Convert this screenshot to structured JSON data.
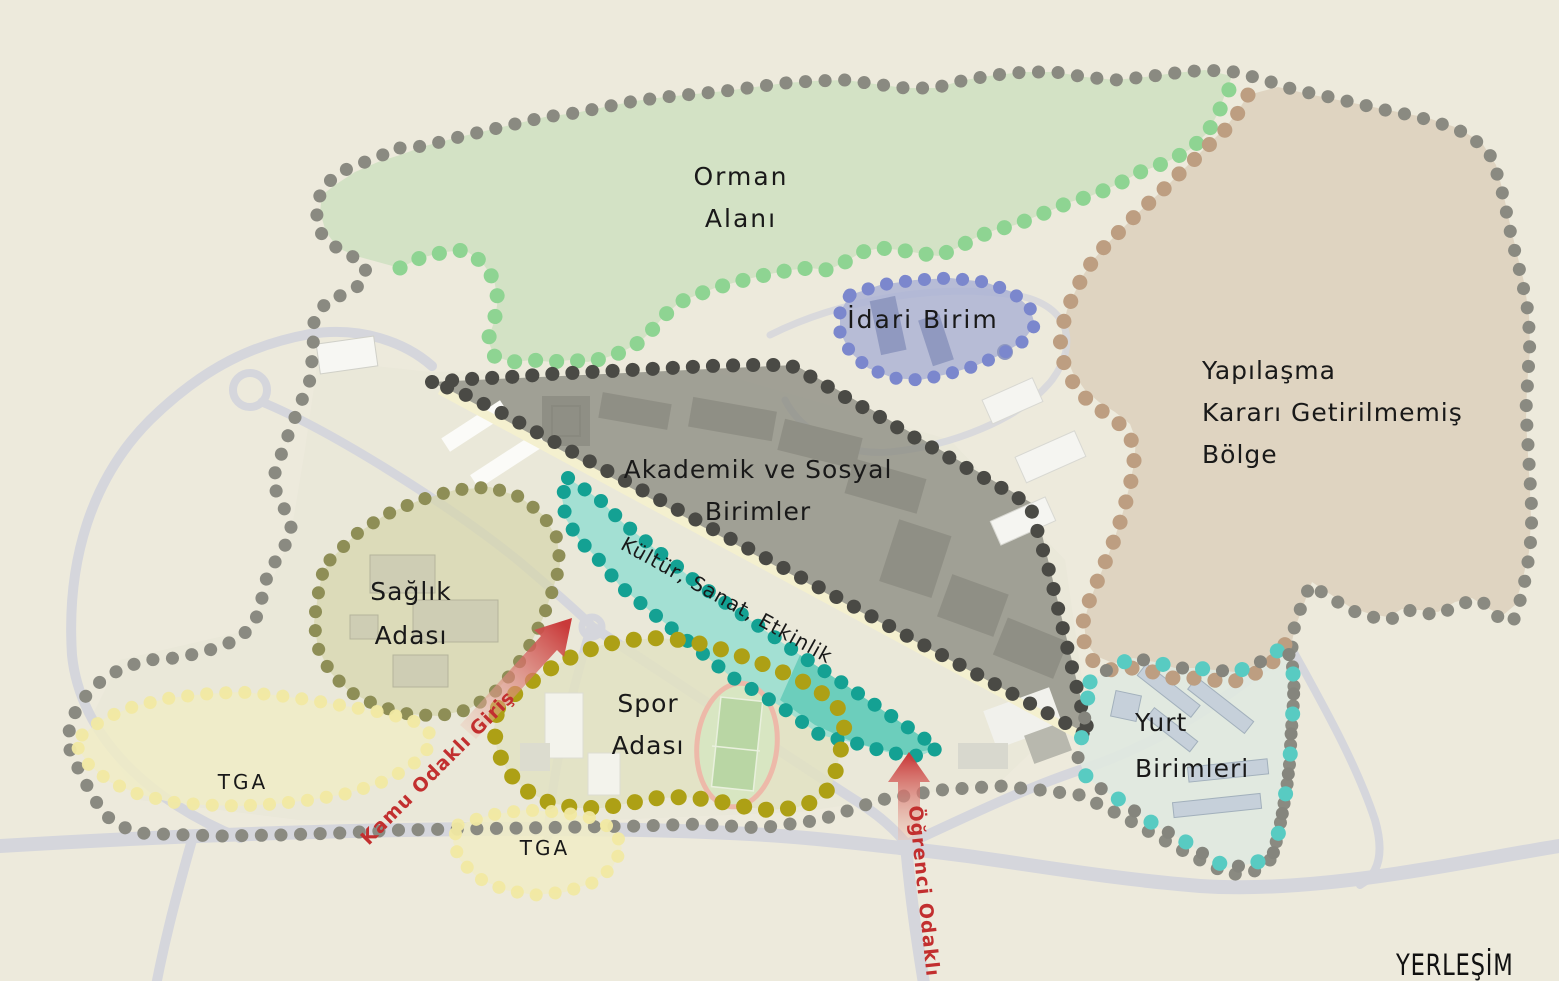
{
  "map": {
    "title": "YERLEŞİM",
    "background_color": "#edeadc",
    "zones": {
      "campus_boundary": {
        "name": "campus outer boundary",
        "dot_color": "#8a8a81"
      },
      "orman": {
        "line1": "Orman",
        "line2": "Alanı",
        "dot_color": "#8ed492",
        "fill": "#cfe0c2"
      },
      "idari": {
        "label": "İdari Birim",
        "dot_color": "#7b87cd",
        "fill": "#a9b0d4"
      },
      "yapilasma": {
        "line1": "Yapılaşma",
        "line2": "Kararı Getirilmemiş",
        "line3": "Bölge",
        "dot_color": "#bd9e81",
        "fill": "#ddd1be"
      },
      "akademik": {
        "line1": "Akademik ve Sosyal",
        "line2": "Birimler",
        "dot_color": "#4a4a45",
        "fill": "#84847a"
      },
      "kultur": {
        "label": "Kültür, Sanat, Etkinlik",
        "dot_color": "#14a193",
        "fill": "#9bdfd2",
        "fill_bright": "#5ec9b6"
      },
      "saglik": {
        "line1": "Sağlık",
        "line2": "Adası",
        "dot_color": "#8e8e56",
        "fill": "#d6d5ab"
      },
      "spor": {
        "line1": "Spor",
        "line2": "Adası",
        "dot_color": "#ada015",
        "fill": "#e2e2c2"
      },
      "tga_west": {
        "label": "TGA",
        "dot_color": "#f1e9a2",
        "fill": "#f0ecc6"
      },
      "tga_south": {
        "label": "TGA",
        "dot_color": "#f1e9a2",
        "fill": "#f0ecc6"
      },
      "yurt": {
        "line1": "Yurt",
        "line2": "Birimleri",
        "dot_color": "#58cbc2",
        "fill": "#dfe8df"
      }
    },
    "entrances": {
      "kamu": {
        "label": "Kamu Odaklı Giriş",
        "color": "#c22f2f",
        "arrow_color": "#c93a3a"
      },
      "ogrenci": {
        "label": "Öğrenci Odaklı Giriş",
        "color": "#c22f2f",
        "arrow_color": "#c93a3a"
      }
    }
  }
}
